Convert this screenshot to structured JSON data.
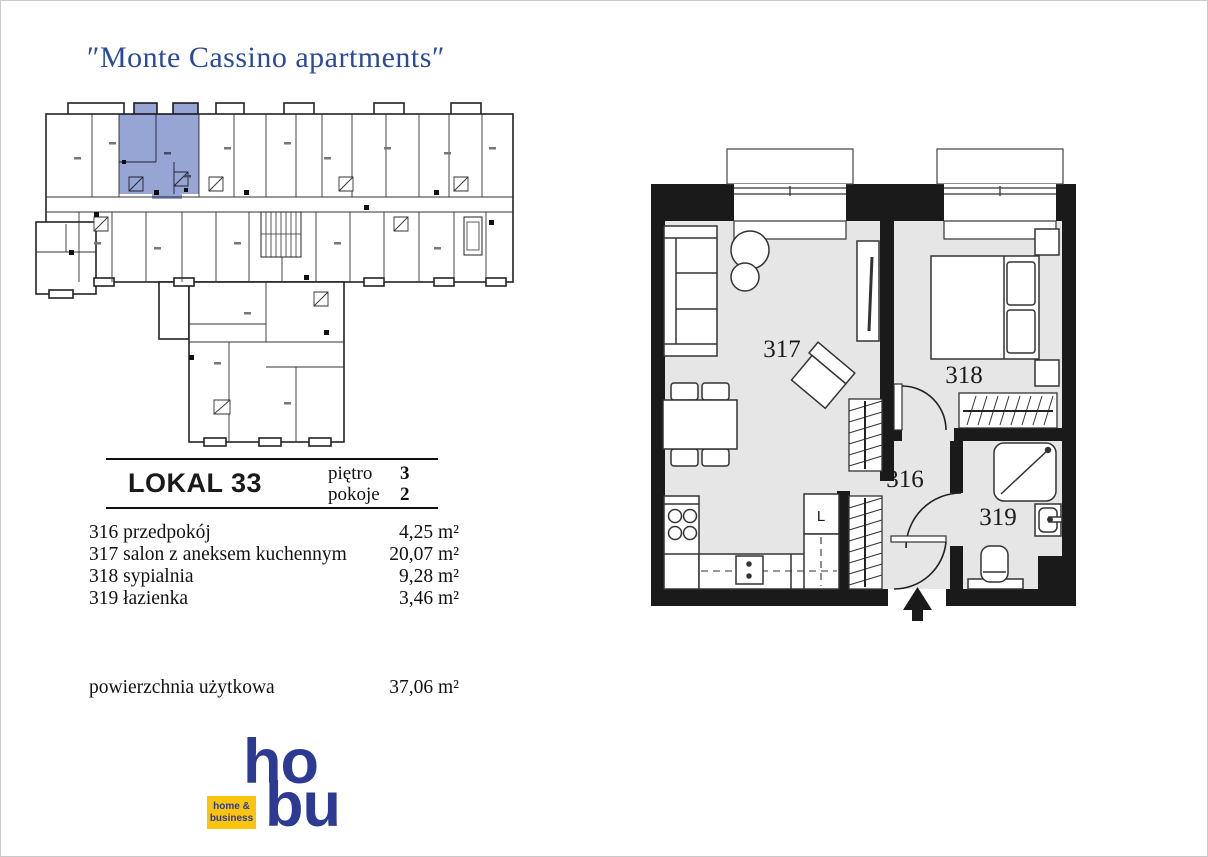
{
  "title": "″Monte Cassino apartments″",
  "unit": {
    "name": "LOKAL 33",
    "floor": {
      "label": "piętro",
      "value": "3"
    },
    "rooms_count": {
      "label": "pokoje",
      "value": "2"
    }
  },
  "room_list": [
    {
      "no": "316",
      "name": "przedpokój",
      "area": "4,25 m²"
    },
    {
      "no": "317",
      "name": "salon z aneksem kuchennym",
      "area": "20,07 m²"
    },
    {
      "no": "318",
      "name": "sypialnia",
      "area": "9,28 m²"
    },
    {
      "no": "319",
      "name": "łazienka",
      "area": "3,46 m²"
    }
  ],
  "total_area": {
    "label": "powierzchnia użytkowa",
    "value": "37,06 m²"
  },
  "floor_plan": {
    "labels": {
      "living": "317",
      "bedroom": "318",
      "hall": "316",
      "bath": "319",
      "fridge": "L"
    }
  },
  "logo": {
    "top": "ho",
    "bottom": "bu",
    "badge": [
      "home &",
      "business"
    ]
  },
  "colors": {
    "brand_blue": "#2B4A9B",
    "logo_blue": "#2D3A91",
    "badge_yellow": "#FBC40F",
    "highlight_blue": "#96A5D4",
    "floor_gray": "#E6E6E6",
    "wall_black": "#1A1A1A"
  }
}
